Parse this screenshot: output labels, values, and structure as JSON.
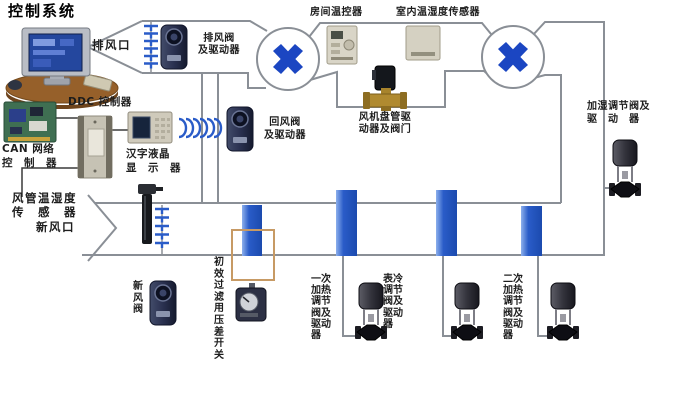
{
  "title": "控制系统",
  "colors": {
    "accent_blue": "#1b46c2",
    "coil_blue": "#2a5cc8",
    "duct_gray": "#8a8f96",
    "filter_box_tan": "#c79a64"
  },
  "labels": {
    "exhaust_outlet": "排风口",
    "exhaust_valve_actuator": "排风阀\n及驱动器",
    "room_thermostat": "房间温控器",
    "indoor_temp_humidity_sensor": "室内温湿度传感器",
    "humidify_valve_actuator": "加湿调节阀及\n驱　动　器",
    "ddc_controller": "DDC 控制器",
    "can_network_controller": "CAN 网络\n控　制　器",
    "lcd_display": "汉字液晶\n显　示　器",
    "return_valve_actuator": "回风阀\n及驱动器",
    "fan_coil_actuator_valve": "风机盘管驱\n动器及阀门",
    "duct_temp_humidity_sensor": "风管温湿度\n传　感　器",
    "fresh_air_inlet": "新风口",
    "fresh_air_valve": "新风阀",
    "filter_pressure_switch": "初效过滤用压差开关",
    "primary_heating_valve": "一次加热调节阀及驱动器",
    "surface_cooling_valve": "表冷调节阀及驱动器",
    "secondary_heating_valve": "二次加热调节阀及驱动器"
  }
}
